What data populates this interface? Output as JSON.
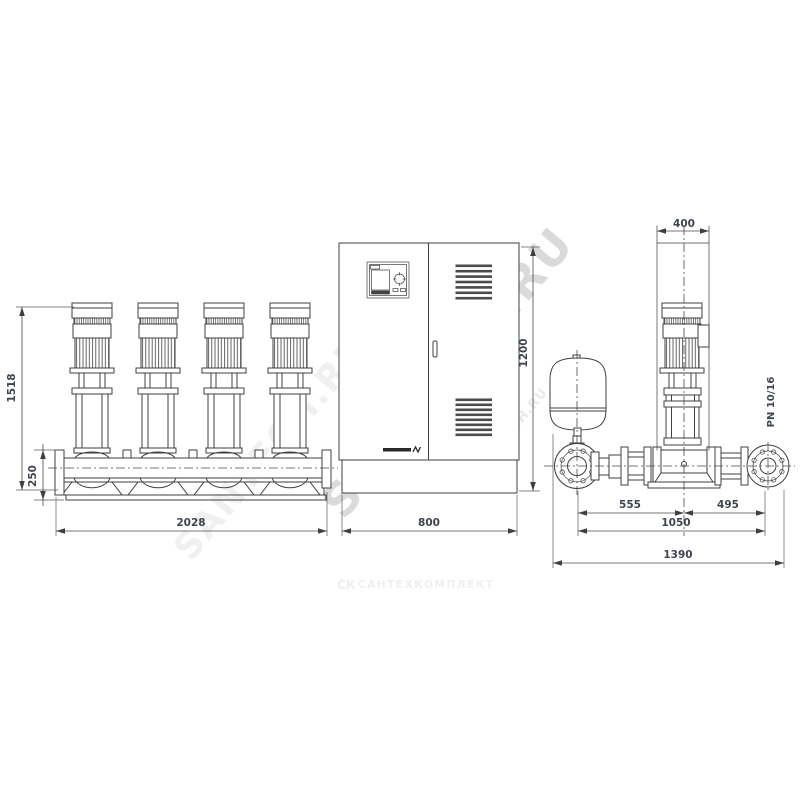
{
  "drawing": {
    "front_view": {
      "dim_height": "1518",
      "dim_manifold_height": "250",
      "dim_width": "2028"
    },
    "cabinet_view": {
      "dim_height": "1200",
      "dim_width": "800"
    },
    "side_view": {
      "dim_motor_width": "400",
      "dim_tank_to_center": "555",
      "dim_center_to_outlet": "495",
      "dim_inner_span": "1050",
      "dim_total_width": "1390",
      "pressure_rating": "PN 10/16"
    }
  },
  "watermark": {
    "main": "SANTECH.RU",
    "faint_left": "SANTECH.RU",
    "faint_right": "SANTECH.RU"
  },
  "footer": {
    "logo": "СК",
    "company": "САНТЕХКОМПЛЕКТ"
  },
  "colors": {
    "line": "#3f3f3f",
    "dim_text": "#3e4550",
    "louver": "#4b4b4b",
    "watermark": "#cecece",
    "watermark_faint": "#efefef",
    "background": "#ffffff"
  }
}
